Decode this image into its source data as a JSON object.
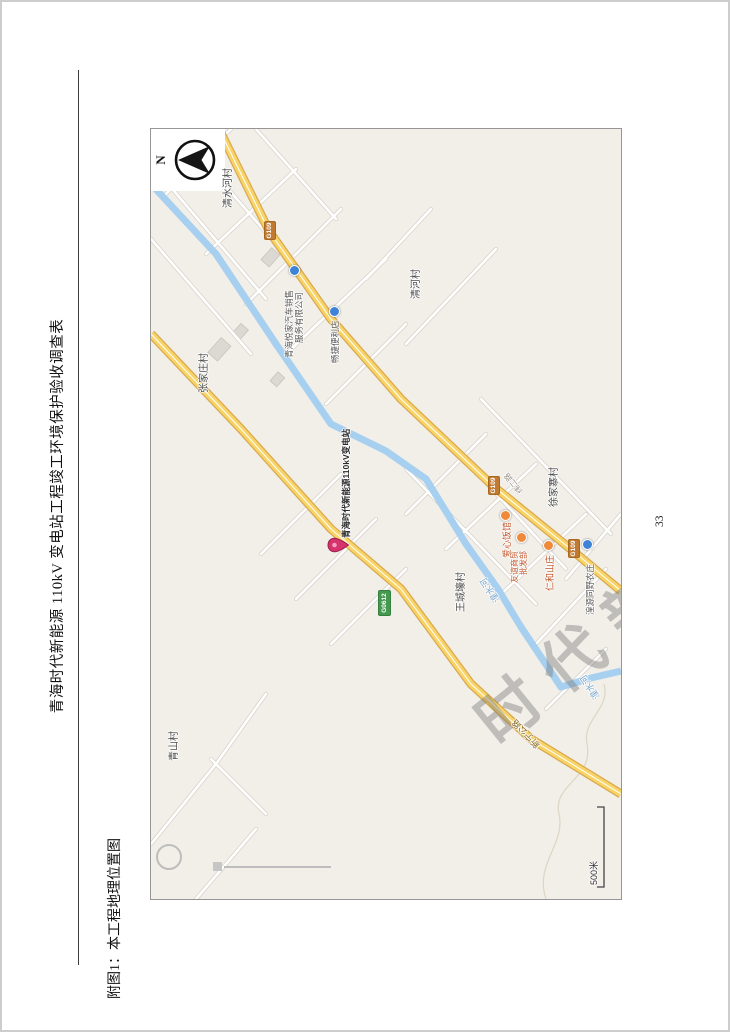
{
  "page": {
    "title": "青海时代新能源 110kV 变电站工程竣工环境保护验收调查表",
    "caption": "附图1：本工程地理位置图",
    "page_number": "33"
  },
  "map": {
    "compass_label": "N",
    "watermark_text": "时代新能源",
    "scale_label": "500米",
    "pin_label": "青海时代新能源110kV变电站",
    "shields": [
      {
        "text": "G109"
      },
      {
        "text": "G109"
      },
      {
        "text": "G109"
      },
      {
        "text": "G0612"
      }
    ],
    "labels": [
      {
        "text": "清水河村"
      },
      {
        "text": "清河村"
      },
      {
        "text": "张家庄村"
      },
      {
        "text": "青山村"
      },
      {
        "text": "王城壕村"
      },
      {
        "text": "徐家寨村"
      },
      {
        "text": "湟水河"
      },
      {
        "text": "湟水河"
      },
      {
        "text": "新宁公路"
      },
      {
        "text": "纬二路"
      },
      {
        "text": "爱心饭馆"
      },
      {
        "text": "友谊商贸"
      },
      {
        "text": "批发部"
      },
      {
        "text": "仁和山庄"
      },
      {
        "text": "湟源同野农庄"
      },
      {
        "text": "畅捷便利店"
      },
      {
        "text": "青海悦家汽车销售"
      },
      {
        "text": "服务有限公司"
      }
    ]
  },
  "colors": {
    "pin": "#d6336c",
    "highway_yellow": "#f8d468",
    "river_blue": "#a7d0f0",
    "map_background": "#f2efe9",
    "shield_orange": "#c17a32",
    "shield_green": "#44994f"
  }
}
